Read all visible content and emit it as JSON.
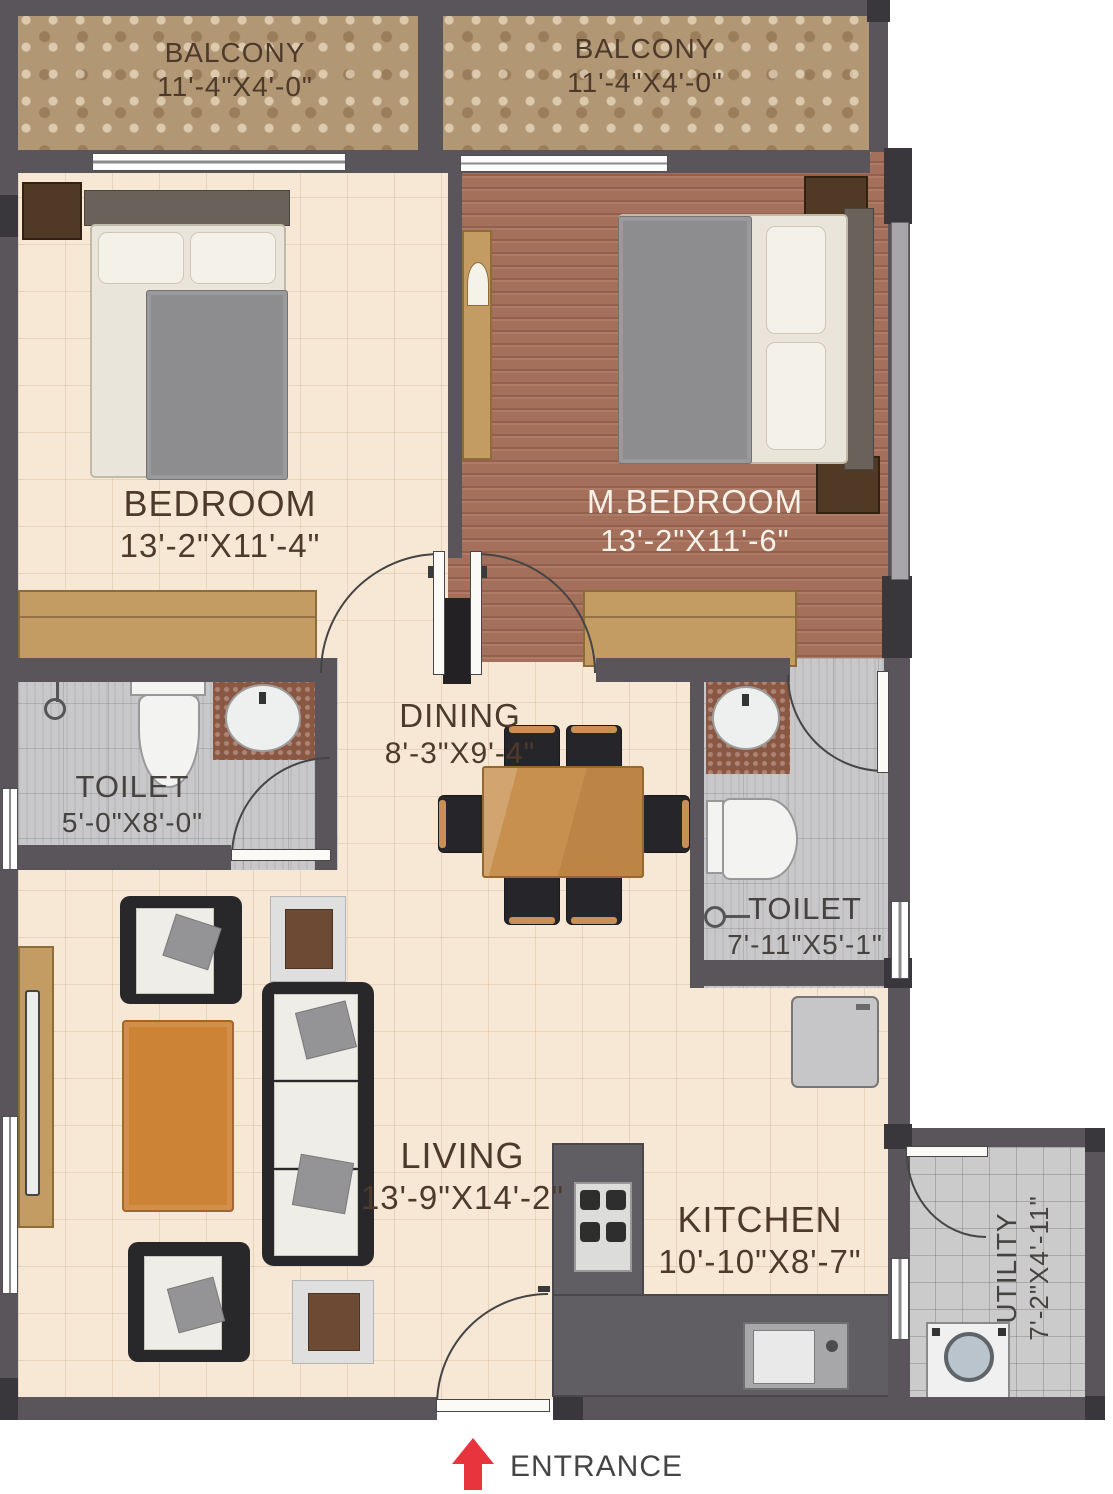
{
  "palette": {
    "wall": "#59555a",
    "wall_dark": "#3a373c",
    "pillar_black": "#232124",
    "balcony_floor": "#b29775",
    "bedroom_floor": "#f6e8d5",
    "master_floor": "#a5705b",
    "toilet_floor": "#c8c8ca",
    "utility_floor": "#cbcbcb",
    "wardrobe": "#c29c63",
    "table_wood": "#c8904f",
    "counter": "#615e63",
    "entrance_red": "#e8353d",
    "label_brown": "#4d3a2b",
    "label_white": "#f7f3ea"
  },
  "rooms": {
    "balcony_left": {
      "name": "BALCONY",
      "dims": "11'-4\"X4'-0\""
    },
    "balcony_right": {
      "name": "BALCONY",
      "dims": "11'-4\"X4'-0\""
    },
    "bedroom": {
      "name": "BEDROOM",
      "dims": "13'-2\"X11'-4\""
    },
    "master_bedroom": {
      "name": "M.BEDROOM",
      "dims": "13'-2\"X11'-6\""
    },
    "toilet_left": {
      "name": "TOILET",
      "dims": "5'-0\"X8'-0\""
    },
    "dining": {
      "name": "DINING",
      "dims": "8'-3\"X9'-4\""
    },
    "toilet_right": {
      "name": "TOILET",
      "dims": "7'-11\"X5'-1\""
    },
    "living": {
      "name": "LIVING",
      "dims": "13'-9\"X14'-2\""
    },
    "kitchen": {
      "name": "KITCHEN",
      "dims": "10'-10\"X8'-7\""
    },
    "utility": {
      "name": "UTILITY",
      "dims": "7'-2\"X4'-11\""
    }
  },
  "entrance": {
    "label": "ENTRANCE",
    "arrow_icon": "entrance-arrow-icon"
  }
}
